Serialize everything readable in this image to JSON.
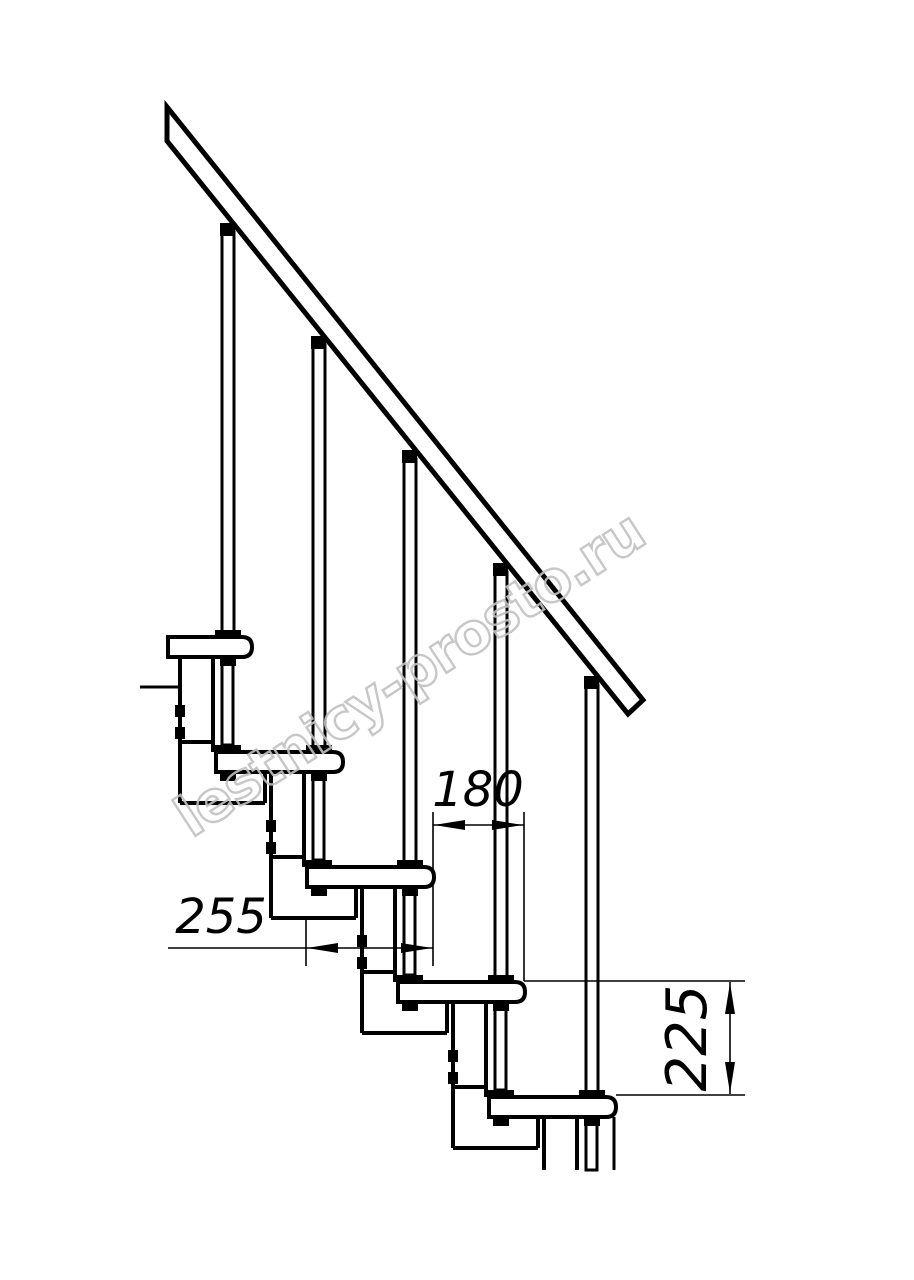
{
  "canvas": {
    "width": 914,
    "height": 1280,
    "background": "#ffffff",
    "ink": "#000000"
  },
  "watermark": {
    "text": "lestnicy-prosto.ru",
    "color": "#c1c1c1",
    "x": 420,
    "y": 690,
    "rotate": -33,
    "font_size": 56,
    "stroke_width": 2.4,
    "opacity": 0.9
  },
  "dimensions": {
    "step_run": "180",
    "tread_depth": "255",
    "step_rise": "225"
  },
  "drawing": {
    "primitives": [
      {
        "name": "module-1-left-edge",
        "type": "line",
        "x1": 180,
        "y1": 657,
        "x2": 180,
        "y2": 803,
        "sw": 4
      },
      {
        "name": "module-1-right-upper-edge",
        "type": "line",
        "x1": 213,
        "y1": 657,
        "x2": 213,
        "y2": 752,
        "sw": 4
      },
      {
        "name": "module-1-ledge",
        "type": "line",
        "x1": 180,
        "y1": 742,
        "x2": 213,
        "y2": 742,
        "sw": 4
      },
      {
        "name": "module-1-right-lower-edge",
        "type": "line",
        "x1": 265,
        "y1": 772,
        "x2": 265,
        "y2": 803,
        "sw": 4
      },
      {
        "name": "module-1-bottom-edge",
        "type": "line",
        "x1": 180,
        "y1": 803,
        "x2": 265,
        "y2": 803,
        "sw": 4
      },
      {
        "name": "module-1-bolt-1",
        "type": "rect",
        "x": 175,
        "y": 705,
        "w": 10,
        "h": 12,
        "fill": "#000"
      },
      {
        "name": "module-1-bolt-2",
        "type": "rect",
        "x": 175,
        "y": 727,
        "w": 10,
        "h": 12,
        "fill": "#000"
      },
      {
        "name": "module-2-left-edge",
        "type": "line",
        "x1": 271,
        "y1": 772,
        "x2": 271,
        "y2": 918,
        "sw": 4
      },
      {
        "name": "module-2-right-upper-edge",
        "type": "line",
        "x1": 304,
        "y1": 772,
        "x2": 304,
        "y2": 867,
        "sw": 4
      },
      {
        "name": "module-2-ledge",
        "type": "line",
        "x1": 271,
        "y1": 857,
        "x2": 304,
        "y2": 857,
        "sw": 4
      },
      {
        "name": "module-2-right-lower-edge",
        "type": "line",
        "x1": 356,
        "y1": 887,
        "x2": 356,
        "y2": 918,
        "sw": 4
      },
      {
        "name": "module-2-bottom-edge",
        "type": "line",
        "x1": 271,
        "y1": 918,
        "x2": 356,
        "y2": 918,
        "sw": 4
      },
      {
        "name": "module-2-bolt-1",
        "type": "rect",
        "x": 266,
        "y": 820,
        "w": 10,
        "h": 12,
        "fill": "#000"
      },
      {
        "name": "module-2-bolt-2",
        "type": "rect",
        "x": 266,
        "y": 842,
        "w": 10,
        "h": 12,
        "fill": "#000"
      },
      {
        "name": "module-3-left-edge",
        "type": "line",
        "x1": 362,
        "y1": 887,
        "x2": 362,
        "y2": 1033,
        "sw": 4
      },
      {
        "name": "module-3-right-upper-edge",
        "type": "line",
        "x1": 395,
        "y1": 887,
        "x2": 395,
        "y2": 982,
        "sw": 4
      },
      {
        "name": "module-3-ledge",
        "type": "line",
        "x1": 362,
        "y1": 972,
        "x2": 395,
        "y2": 972,
        "sw": 4
      },
      {
        "name": "module-3-right-lower-edge",
        "type": "line",
        "x1": 447,
        "y1": 1002,
        "x2": 447,
        "y2": 1033,
        "sw": 4
      },
      {
        "name": "module-3-bottom-edge",
        "type": "line",
        "x1": 362,
        "y1": 1033,
        "x2": 447,
        "y2": 1033,
        "sw": 4
      },
      {
        "name": "module-3-bolt-1",
        "type": "rect",
        "x": 357,
        "y": 935,
        "w": 10,
        "h": 12,
        "fill": "#000"
      },
      {
        "name": "module-3-bolt-2",
        "type": "rect",
        "x": 357,
        "y": 957,
        "w": 10,
        "h": 12,
        "fill": "#000"
      },
      {
        "name": "module-4-left-edge",
        "type": "line",
        "x1": 453,
        "y1": 1002,
        "x2": 453,
        "y2": 1148,
        "sw": 4
      },
      {
        "name": "module-4-right-upper-edge",
        "type": "line",
        "x1": 486,
        "y1": 1002,
        "x2": 486,
        "y2": 1097,
        "sw": 4
      },
      {
        "name": "module-4-ledge",
        "type": "line",
        "x1": 453,
        "y1": 1087,
        "x2": 486,
        "y2": 1087,
        "sw": 4
      },
      {
        "name": "module-4-right-lower-edge",
        "type": "line",
        "x1": 538,
        "y1": 1117,
        "x2": 538,
        "y2": 1148,
        "sw": 4
      },
      {
        "name": "module-4-bottom-edge",
        "type": "line",
        "x1": 453,
        "y1": 1148,
        "x2": 538,
        "y2": 1148,
        "sw": 4
      },
      {
        "name": "module-4-bolt-1",
        "type": "rect",
        "x": 448,
        "y": 1050,
        "w": 10,
        "h": 12,
        "fill": "#000"
      },
      {
        "name": "module-4-bolt-2",
        "type": "rect",
        "x": 448,
        "y": 1072,
        "w": 10,
        "h": 12,
        "fill": "#000"
      },
      {
        "name": "module-5-left-edge-cut",
        "type": "line",
        "x1": 544,
        "y1": 1117,
        "x2": 544,
        "y2": 1170,
        "sw": 4
      },
      {
        "name": "module-5-right-edge-cut",
        "type": "line",
        "x1": 577,
        "y1": 1117,
        "x2": 577,
        "y2": 1170,
        "sw": 4
      },
      {
        "name": "module-5-nose-support-cut",
        "type": "line",
        "x1": 614,
        "y1": 1117,
        "x2": 614,
        "y2": 1170,
        "sw": 3
      },
      {
        "name": "platform-stub-line",
        "type": "line",
        "x1": 140,
        "y1": 687,
        "x2": 180,
        "y2": 687,
        "sw": 3
      },
      {
        "name": "tread-1",
        "type": "tread",
        "x": 168,
        "y": 637,
        "w": 84,
        "h": 20,
        "r": 10,
        "sw": 4
      },
      {
        "name": "tread-2",
        "type": "tread",
        "x": 216,
        "y": 752,
        "w": 127,
        "h": 20,
        "r": 10,
        "sw": 4
      },
      {
        "name": "tread-3",
        "type": "tread",
        "x": 307,
        "y": 867,
        "w": 127,
        "h": 20,
        "r": 10,
        "sw": 4
      },
      {
        "name": "tread-4",
        "type": "tread",
        "x": 398,
        "y": 982,
        "w": 127,
        "h": 20,
        "r": 10,
        "sw": 4
      },
      {
        "name": "tread-5",
        "type": "tread",
        "x": 489,
        "y": 1097,
        "w": 127,
        "h": 20,
        "r": 10,
        "sw": 4
      },
      {
        "name": "handrail",
        "type": "poly",
        "points": "167,107 643,700 628,714 167,141",
        "fill": "#fff",
        "sw": 5
      },
      {
        "name": "baluster-1-subrod",
        "type": "rect",
        "x": 222,
        "y": 657,
        "w": 11,
        "h": 88,
        "fill": "#fff",
        "sw": 3
      },
      {
        "name": "baluster-1-rod",
        "type": "rect",
        "x": 222,
        "y": 232,
        "w": 12,
        "h": 405,
        "fill": "#fff",
        "sw": 3
      },
      {
        "name": "baluster-1-rail-cap",
        "type": "rect",
        "x": 220,
        "y": 223,
        "w": 15,
        "h": 13,
        "fill": "#000"
      },
      {
        "name": "baluster-1-tread-flange",
        "type": "rect",
        "x": 215,
        "y": 630,
        "w": 26,
        "h": 7,
        "fill": "#000"
      },
      {
        "name": "baluster-1-nut-upper",
        "type": "rect",
        "x": 220,
        "y": 658,
        "w": 16,
        "h": 8,
        "fill": "#000"
      },
      {
        "name": "baluster-1-subflange",
        "type": "rect",
        "x": 215,
        "y": 745,
        "w": 26,
        "h": 7,
        "fill": "#000"
      },
      {
        "name": "baluster-1-nut-lower",
        "type": "rect",
        "x": 220,
        "y": 773,
        "w": 16,
        "h": 8,
        "fill": "#000"
      },
      {
        "name": "baluster-2-subrod",
        "type": "rect",
        "x": 313,
        "y": 772,
        "w": 11,
        "h": 88,
        "fill": "#fff",
        "sw": 3
      },
      {
        "name": "baluster-2-rod",
        "type": "rect",
        "x": 313,
        "y": 345,
        "w": 12,
        "h": 407,
        "fill": "#fff",
        "sw": 3
      },
      {
        "name": "baluster-2-rail-cap",
        "type": "rect",
        "x": 311,
        "y": 336,
        "w": 15,
        "h": 13,
        "fill": "#000"
      },
      {
        "name": "baluster-2-tread-flange",
        "type": "rect",
        "x": 306,
        "y": 745,
        "w": 26,
        "h": 7,
        "fill": "#000"
      },
      {
        "name": "baluster-2-nut-upper",
        "type": "rect",
        "x": 311,
        "y": 773,
        "w": 16,
        "h": 8,
        "fill": "#000"
      },
      {
        "name": "baluster-2-subflange",
        "type": "rect",
        "x": 306,
        "y": 860,
        "w": 26,
        "h": 7,
        "fill": "#000"
      },
      {
        "name": "baluster-2-nut-lower",
        "type": "rect",
        "x": 311,
        "y": 888,
        "w": 16,
        "h": 8,
        "fill": "#000"
      },
      {
        "name": "baluster-3-subrod",
        "type": "rect",
        "x": 404,
        "y": 887,
        "w": 11,
        "h": 88,
        "fill": "#fff",
        "sw": 3
      },
      {
        "name": "baluster-3-rod",
        "type": "rect",
        "x": 404,
        "y": 459,
        "w": 12,
        "h": 408,
        "fill": "#fff",
        "sw": 3
      },
      {
        "name": "baluster-3-rail-cap",
        "type": "rect",
        "x": 402,
        "y": 450,
        "w": 15,
        "h": 13,
        "fill": "#000"
      },
      {
        "name": "baluster-3-tread-flange",
        "type": "rect",
        "x": 397,
        "y": 860,
        "w": 26,
        "h": 7,
        "fill": "#000"
      },
      {
        "name": "baluster-3-nut-upper",
        "type": "rect",
        "x": 402,
        "y": 888,
        "w": 16,
        "h": 8,
        "fill": "#000"
      },
      {
        "name": "baluster-3-subflange",
        "type": "rect",
        "x": 397,
        "y": 975,
        "w": 26,
        "h": 7,
        "fill": "#000"
      },
      {
        "name": "baluster-3-nut-lower",
        "type": "rect",
        "x": 402,
        "y": 1003,
        "w": 16,
        "h": 8,
        "fill": "#000"
      },
      {
        "name": "baluster-4-subrod",
        "type": "rect",
        "x": 495,
        "y": 1002,
        "w": 11,
        "h": 88,
        "fill": "#fff",
        "sw": 3
      },
      {
        "name": "baluster-4-rod",
        "type": "rect",
        "x": 495,
        "y": 572,
        "w": 12,
        "h": 410,
        "fill": "#fff",
        "sw": 3
      },
      {
        "name": "baluster-4-rail-cap",
        "type": "rect",
        "x": 493,
        "y": 563,
        "w": 15,
        "h": 13,
        "fill": "#000"
      },
      {
        "name": "baluster-4-tread-flange",
        "type": "rect",
        "x": 488,
        "y": 975,
        "w": 26,
        "h": 7,
        "fill": "#000"
      },
      {
        "name": "baluster-4-nut-upper",
        "type": "rect",
        "x": 493,
        "y": 1003,
        "w": 16,
        "h": 8,
        "fill": "#000"
      },
      {
        "name": "baluster-4-subflange",
        "type": "rect",
        "x": 488,
        "y": 1090,
        "w": 26,
        "h": 7,
        "fill": "#000"
      },
      {
        "name": "baluster-4-nut-lower",
        "type": "rect",
        "x": 493,
        "y": 1118,
        "w": 16,
        "h": 8,
        "fill": "#000"
      },
      {
        "name": "baluster-5-subrod",
        "type": "rect",
        "x": 586,
        "y": 1117,
        "w": 11,
        "h": 53,
        "fill": "#fff",
        "sw": 3
      },
      {
        "name": "baluster-5-rod",
        "type": "rect",
        "x": 586,
        "y": 685,
        "w": 12,
        "h": 412,
        "fill": "#fff",
        "sw": 3
      },
      {
        "name": "baluster-5-rail-cap",
        "type": "rect",
        "x": 584,
        "y": 676,
        "w": 15,
        "h": 13,
        "fill": "#000"
      },
      {
        "name": "baluster-5-tread-flange",
        "type": "rect",
        "x": 579,
        "y": 1090,
        "w": 26,
        "h": 7,
        "fill": "#000"
      },
      {
        "name": "baluster-5-nut-upper",
        "type": "rect",
        "x": 584,
        "y": 1118,
        "w": 16,
        "h": 8,
        "fill": "#000"
      },
      {
        "name": "watermark-text",
        "type": "text",
        "cls": "wm",
        "text": "lestnicy-prosto.ru",
        "x": 420,
        "y": 690,
        "fs": 56,
        "rotate": -33,
        "fill": "none",
        "stroke": "#c1c1c1",
        "sw": 2.4,
        "opacity": 0.9,
        "spacing": -1
      },
      {
        "name": "dim-180-ext-left",
        "type": "line",
        "x1": 433,
        "y1": 812,
        "x2": 433,
        "y2": 966,
        "sw": 1.6
      },
      {
        "name": "dim-180-ext-right",
        "type": "line",
        "x1": 524,
        "y1": 812,
        "x2": 524,
        "y2": 981,
        "sw": 1.6
      },
      {
        "name": "dim-180-line",
        "type": "line",
        "x1": 433,
        "y1": 825,
        "x2": 524,
        "y2": 825,
        "sw": 1.6
      },
      {
        "name": "dim-180-arrow-left",
        "type": "poly",
        "points": "434,825 465,820 465,830",
        "fill": "#000"
      },
      {
        "name": "dim-180-arrow-right",
        "type": "poly",
        "points": "523,825 492,820 492,830",
        "fill": "#000"
      },
      {
        "name": "dim-180-label",
        "type": "text",
        "cls": "dim",
        "text": "180",
        "x": 478,
        "y": 806,
        "fs": 48
      },
      {
        "name": "dim-255-ext-left",
        "type": "line",
        "x1": 306,
        "y1": 920,
        "x2": 306,
        "y2": 966,
        "sw": 1.6
      },
      {
        "name": "dim-255-line",
        "type": "line",
        "x1": 168,
        "y1": 948,
        "x2": 433,
        "y2": 948,
        "sw": 1.6
      },
      {
        "name": "dim-255-arrow-left",
        "type": "poly",
        "points": "307,948 338,943 338,953",
        "fill": "#000"
      },
      {
        "name": "dim-255-arrow-right",
        "type": "poly",
        "points": "432,948 401,943 401,953",
        "fill": "#000"
      },
      {
        "name": "dim-255-label",
        "type": "text",
        "cls": "dim",
        "text": "255",
        "x": 221,
        "y": 933,
        "fs": 48
      },
      {
        "name": "dim-225-ext-top",
        "type": "line",
        "x1": 524,
        "y1": 981,
        "x2": 745,
        "y2": 981,
        "sw": 1.6
      },
      {
        "name": "dim-225-ext-bottom",
        "type": "line",
        "x1": 616,
        "y1": 1095,
        "x2": 745,
        "y2": 1095,
        "sw": 1.6
      },
      {
        "name": "dim-225-line",
        "type": "line",
        "x1": 730,
        "y1": 982,
        "x2": 730,
        "y2": 1094,
        "sw": 1.6
      },
      {
        "name": "dim-225-arrow-top",
        "type": "poly",
        "points": "730,983 725,1014 735,1014",
        "fill": "#000"
      },
      {
        "name": "dim-225-arrow-bottom",
        "type": "poly",
        "points": "730,1093 725,1062 735,1062",
        "fill": "#000"
      },
      {
        "name": "dim-225-label",
        "type": "text",
        "cls": "dim",
        "text": "225",
        "x": 706,
        "y": 1038,
        "fs": 56,
        "rotate": -90
      }
    ]
  }
}
